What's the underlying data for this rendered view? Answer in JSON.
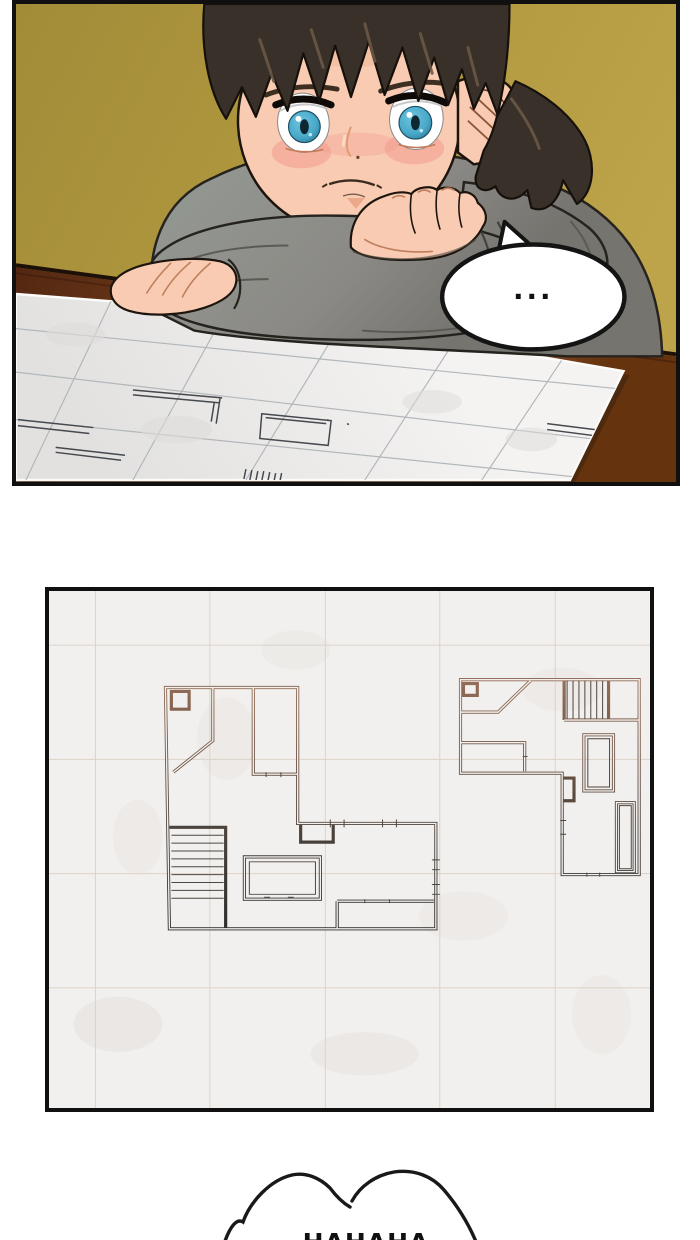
{
  "page": {
    "kind": "webtoon comic strip segment",
    "background": "#ffffff",
    "width": 700,
    "height": 1240
  },
  "panel1": {
    "description": "Boy resting crossed arms on a wooden table, staring down at an architectural blueprint",
    "background": "#af973f",
    "border_color": "#101010",
    "table": {
      "surface": "#7c4620",
      "shadow": "#52250e",
      "edge_line": "#1d1009"
    },
    "blueprint_paper": {
      "fill": "#efeeed",
      "grid": "#b3b7ba",
      "plan_lines": "#45484d",
      "edge_highlight": "#ffffff"
    },
    "character": {
      "name": "boy",
      "hair": "#39302a",
      "hair_highlight": "#6b5946",
      "skin": "#f8cbb2",
      "blush": "#f2968a",
      "eye_iris": "#49a9c9",
      "eye_pupil": "#0f2730",
      "sweater": "#8b8985",
      "sweater_shadow": "#6e6c68",
      "collar": "#474139",
      "outline": "#1d150d"
    },
    "speech_bubble": {
      "text": "...",
      "fill": "#ffffff",
      "stroke": "#141414"
    }
  },
  "panel2": {
    "description": "Close-up of the blueprint sheet: two floor plans drawn on faint grid paper",
    "border_color": "#101010",
    "paper": "#f2f0ee",
    "grid": "#dcd2c8",
    "plan_stroke_top": "#96705a",
    "plan_stroke_bottom": "#2f2c29",
    "left_plan": "large L-shaped unit with corner closet, diagonal wall, interior room, staircase, table and counters",
    "right_plan": "smaller L-shaped unit with closet, diagonal wall, staircase, bathtub and storage"
  },
  "bottom_bubble": {
    "text": "HAHAHA",
    "note": "cloud-shaped shout bubble cut off by the bottom edge; only the top of the letters is visible",
    "fill": "#ffffff",
    "stroke": "#191919"
  }
}
